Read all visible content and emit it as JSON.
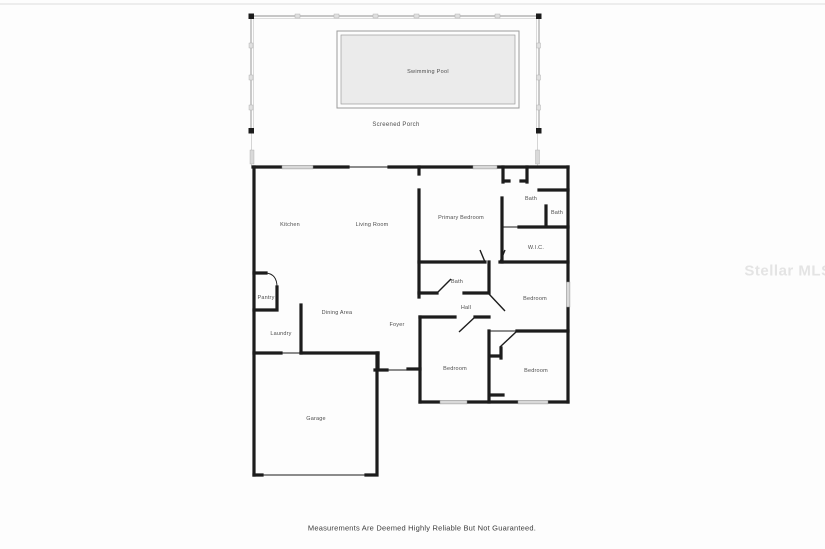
{
  "page": {
    "disclaimer": "Measurements Are Deemed Highly Reliable But Not Guaranteed.",
    "watermark": "Stellar MLS"
  },
  "porch": {
    "label": "Screened Porch",
    "pool_label": "Swimming Pool"
  },
  "rooms": [
    {
      "id": "kitchen",
      "label": "Kitchen",
      "x": 290,
      "y": 225
    },
    {
      "id": "living-room",
      "label": "Living Room",
      "x": 372,
      "y": 225
    },
    {
      "id": "primary-bedroom",
      "label": "Primary Bedroom",
      "x": 461,
      "y": 218
    },
    {
      "id": "primary-bath",
      "label": "Bath",
      "x": 531,
      "y": 199
    },
    {
      "id": "primary-bath-2",
      "label": "Bath",
      "x": 557,
      "y": 213
    },
    {
      "id": "walk-in-closet",
      "label": "W.I.C.",
      "x": 536,
      "y": 248
    },
    {
      "id": "pantry",
      "label": "Pantry",
      "x": 266,
      "y": 298
    },
    {
      "id": "hall-bath",
      "label": "Bath",
      "x": 457,
      "y": 282
    },
    {
      "id": "bedroom-east",
      "label": "Bedroom",
      "x": 535,
      "y": 299
    },
    {
      "id": "hall",
      "label": "Hall",
      "x": 466,
      "y": 308
    },
    {
      "id": "dining-area",
      "label": "Dining Area",
      "x": 337,
      "y": 313
    },
    {
      "id": "foyer",
      "label": "Foyer",
      "x": 397,
      "y": 325
    },
    {
      "id": "laundry",
      "label": "Laundry",
      "x": 281,
      "y": 334
    },
    {
      "id": "bedroom-southwest",
      "label": "Bedroom",
      "x": 455,
      "y": 369
    },
    {
      "id": "bedroom-southeast",
      "label": "Bedroom",
      "x": 536,
      "y": 371
    },
    {
      "id": "garage",
      "label": "Garage",
      "x": 316,
      "y": 419
    }
  ],
  "colors": {
    "wall": "#1c1c1c",
    "porch_line": "#b5b5b5",
    "pool_fill": "#ebebeb",
    "pool_border": "#9c9c9c",
    "window_fill": "#d9d9d9",
    "label_text": "#4d4d4d",
    "disclaimer_text": "#3d3d3d",
    "watermark_text": "#e4e4e4"
  }
}
